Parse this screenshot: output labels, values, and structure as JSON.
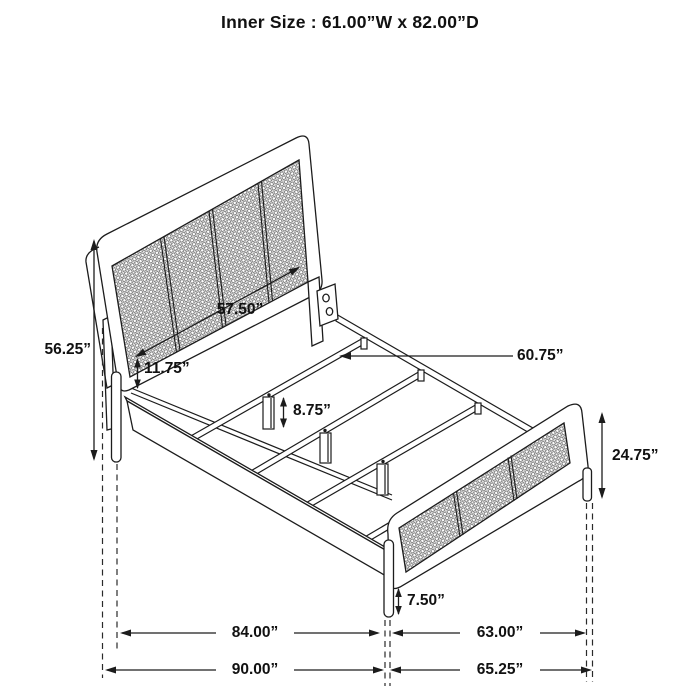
{
  "title": "Inner Size : 61.00”W x 82.00”D",
  "dimensions": {
    "headboard_height": "56.25”",
    "headboard_width": "57.50”",
    "rail_offset": "11.75”",
    "center_leg_height": "8.75”",
    "slat_length": "60.75”",
    "footboard_height": "24.75”",
    "footboard_leg_height": "7.50”",
    "side_rail_length": "84.00”",
    "footboard_span": "63.00”",
    "overall_length": "90.00”",
    "overall_width": "65.25”"
  }
}
